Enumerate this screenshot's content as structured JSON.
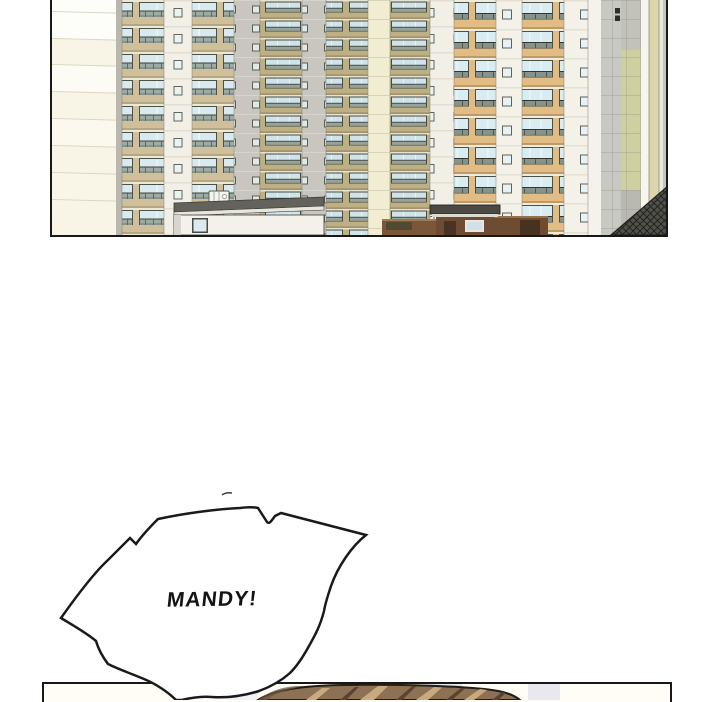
{
  "comic": {
    "speech_bubble": {
      "text": "MANDY!"
    },
    "panels": {
      "apartment": {
        "description": "Daytime view of a high-rise apartment complex with balconies, a low annex building with rooftop AC unit, a brown gatehouse and perimeter wall, and a dark hatched building at the corner"
      },
      "character": {
        "description": "Top of a person's head with brown hair entering from the bottom panel"
      }
    },
    "palette": {
      "outline": "#1a1a1a",
      "background": "#ffffff",
      "cream_wall": "#f5f1da",
      "spandrel_tan": "#cfc09b",
      "spandrel_khaki": "#bdb083",
      "spandrel_orange": "#e2bc85",
      "window_glass": "#d8e9ef",
      "pier_white": "#f1efe6",
      "pier_gray": "#c8c6bf",
      "facade_green": "#ced0a0",
      "roof_gray": "#63625c",
      "gate_brown": "#6e4b33",
      "fence_brown": "#7a563b",
      "hatch_dark": "#51514b",
      "hair_brown": "#8d7154",
      "hair_highlight": "#c9aa7f",
      "hair_shadow": "#5a4233"
    }
  }
}
